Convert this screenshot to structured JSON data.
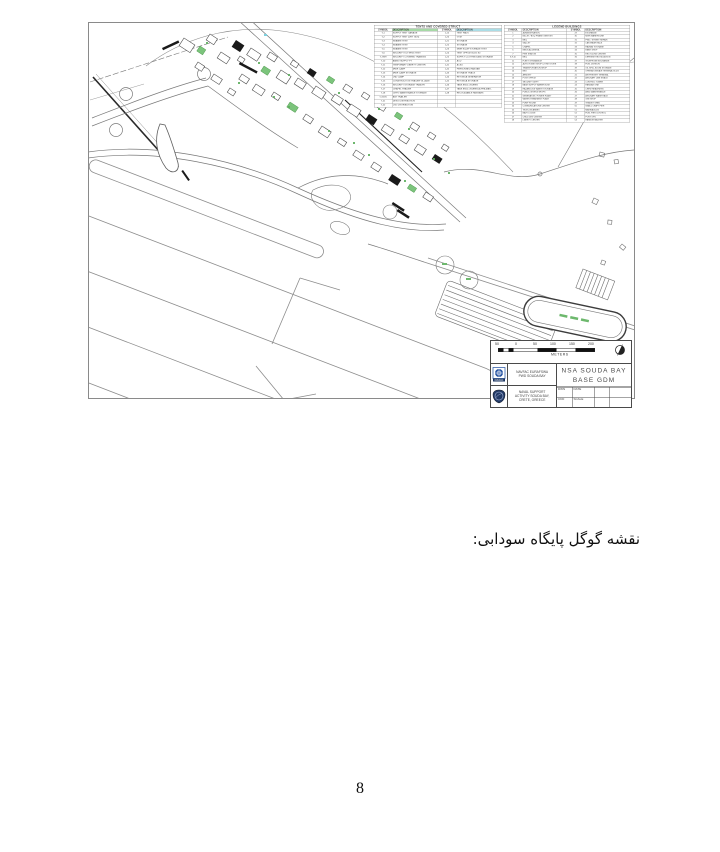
{
  "page": {
    "caption_rtl": "نقشه گوگل پایگاه سودابی:",
    "number": "8"
  },
  "figure": {
    "colors": {
      "map_green": "#6db86d",
      "map_cyan": "#7ecfdd",
      "navy": "#1d3a6e",
      "highlight_green": "#a6d9a6",
      "highlight_cyan": "#aadde6"
    },
    "legend_left": {
      "title": "TENTS AND COVERED STRUCT",
      "headers": [
        "SYMBOL",
        "DESCRIPTION",
        "SYMBOL",
        "DESCRIPTION"
      ],
      "rows": [
        [
          "T-1",
          "SUPPLY TENT GARAGE",
          "1-15",
          "TENT PADS"
        ],
        [
          "T-2",
          "SUPPLY TENT (DRY GDS)",
          "1-20",
          "GYM"
        ],
        [
          "T-3",
          "SEABEE TENT",
          "1-21",
          "STORAGE"
        ],
        [
          "T-4",
          "SEABEE TENT",
          "1-22",
          "STORAGE"
        ],
        [
          "T-5",
          "SEABEE TENT",
          "1-23",
          "MWR EQUIP STORAGE TENT"
        ],
        [
          "T-6",
          "SECURITY K-9 TRNG TENT",
          "1-24",
          "TENT OFFICE BLDG 80"
        ],
        [
          "T-7/8/9",
          "SECURITY COVERED TRAINING",
          "1-25",
          "SUPPLY CLOTHING AND STORAGE"
        ],
        [
          "T-10",
          "AMMO SUPPLY PT",
          "1-40",
          "ACU"
        ],
        [
          "T-11",
          "TEMPORARY LIBERTY CENTER",
          "1-41",
          "ACSU"
        ],
        [
          "T-12",
          "MWR CAMP",
          "1-42",
          "PERSONNEL HANGAR"
        ],
        [
          "T-13",
          "MWR CAMP STORAGE",
          "1-43",
          "STORAGE TRACK"
        ],
        [
          "T-14",
          "LND CAMP",
          "1-44",
          "RETONDA GENERATOR"
        ],
        [
          "T-15",
          "CONSTRUCTION TRAILER VILLAGE",
          "1-45",
          "RETONDA STORAGE"
        ],
        [
          "T-16",
          "SECURITY STORAGE TRAILER",
          "1-46",
          "TANK ENCLOSURES"
        ],
        [
          "T-17",
          "CHAPEL TRAILER",
          "1-47",
          "TANK ENCLOSURES ALPHA MATL"
        ],
        [
          "T-18",
          "CHPO MAINTENANCE STORAGE",
          "1-48",
          "RELOCATABLE HANGARS"
        ],
        [
          "T-19/20",
          "ANT TRAILER",
          "",
          ""
        ],
        [
          "T-21",
          "DESO DISTRIBUTION",
          "",
          ""
        ],
        [
          "T-22",
          "LSO DISTRIBUTION",
          "",
          ""
        ]
      ]
    },
    "legend_right": {
      "title": "LEGEND  BUILDINGS",
      "headers": [
        "SYMBOL",
        "DESCRIPTION",
        "SYMBOL",
        "DESCRIPTION"
      ],
      "rows": [
        [
          "1",
          "ADMINISTRATION",
          "29",
          "EXCHANGE"
        ],
        [
          "2",
          "BILLET / BOQ PHASE ONE/TWO",
          "30",
          "MWR WAREHOUSE"
        ],
        [
          "3",
          "BEQ",
          "31",
          "PWD / STREET REPAIR"
        ],
        [
          "4",
          "GALLEY",
          "32",
          "CAR WASH RACK"
        ],
        [
          "5",
          "CHAPEL",
          "33",
          "HAZMAT STORAGE"
        ],
        [
          "6",
          "MEDICAL/DENTAL",
          "34",
          "PAINT SHOP"
        ],
        [
          "7",
          "FIRE STATION",
          "35",
          "RECYCLING CENTER"
        ],
        [
          "8,9,10",
          "BEQ",
          "36",
          "DEFENSE REUTILIZATION"
        ],
        [
          "11",
          "FLEET GYMNASIUM",
          "37",
          "TELEPHONE EXCHANGE"
        ],
        [
          "12",
          "AUTO HOBBY SHOP & TIRE STORE",
          "38",
          "FUEL DIVISION"
        ],
        [
          "13",
          "TRANSPORTATION SHOP",
          "39",
          "OIL SPILL BOOM STORAGE"
        ],
        [
          "14",
          "NEX",
          "40",
          "OPERATIONS/AIR TERMINAL BLDG"
        ],
        [
          "15",
          "ARMORY",
          "41",
          "AIR FREIGHT TERMINAL"
        ],
        [
          "16",
          "POST OFFICE",
          "42",
          "AIRCRAFT LINE SHACK"
        ],
        [
          "17",
          "SECURITY DEPT",
          "43",
          "CONTROL TOWER"
        ],
        [
          "18",
          "BASE SUPPLY WAREHOUSE",
          "44",
          "HANGAR ONE"
        ],
        [
          "19",
          "HAZARDOUS WASTE STORAGE",
          "45",
          "CREW READINESS"
        ],
        [
          "20",
          "PUBLIC WORKS SHOPS",
          "46",
          "AIMD MAINTENANCE"
        ],
        [
          "21",
          "GENERATOR / POWER PLANT",
          "47",
          "AIRCRAFT WASH RACK"
        ],
        [
          "22",
          "WATER TREATMENT PLANT",
          "48",
          "GSE SHOP"
        ],
        [
          "23",
          "PUMP HOUSE",
          "49",
          "TRANSIT SHED"
        ],
        [
          "24",
          "COMMUNICATIONS CENTER",
          "50",
          "SMALL CRAFT PIER"
        ],
        [
          "25",
          "TELECOM ANNEX",
          "51",
          "MARINA BLDG"
        ],
        [
          "26",
          "NAVY LODGE",
          "52",
          "FUEL PIER CONTROL"
        ],
        [
          "27",
          "CHILD DEV CENTER",
          "53",
          "PORT OPS"
        ],
        [
          "28",
          "LIBERTY CENTER",
          "54",
          "HARBOR MASTER"
        ]
      ]
    },
    "scale_bar": {
      "ticks": [
        "50",
        "0",
        "50",
        "100",
        "150",
        "200"
      ],
      "unit": "METERS"
    },
    "title_block": {
      "org1_lines": [
        "NAVFAC EURAFSWA",
        "PWD SOUDA BAY"
      ],
      "org2_lines": [
        "NAVAL SUPPORT",
        "ACTIVITY SOUDA BAY,",
        "CRETE, GREECE"
      ],
      "title_line1": "NSA SOUDA BAY",
      "title_line2": "BASE GDM",
      "logo1_text": "NAVFAC",
      "fields": {
        "f1": "DWN",
        "f2": "DATE",
        "f3": "CKD",
        "f4": "SCALE"
      }
    }
  }
}
